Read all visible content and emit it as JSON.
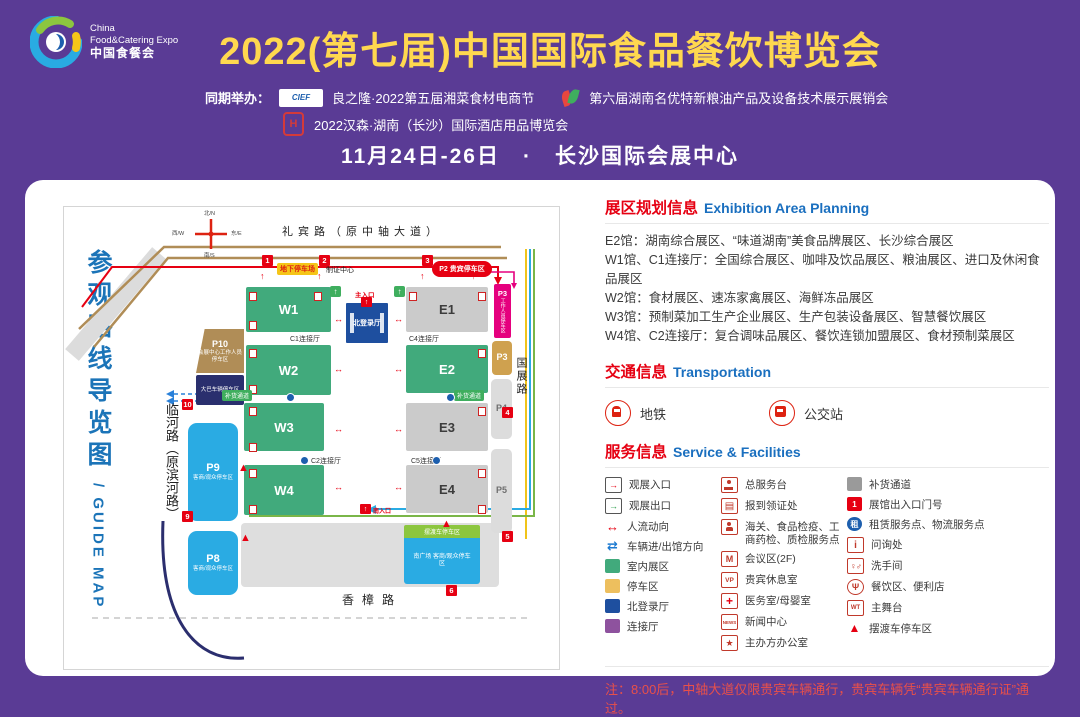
{
  "theme": {
    "purple": "#5a3b95",
    "title_yellow": "#ffd84f",
    "guide_blue": "#1b74b8",
    "section_red": "#e60012",
    "section_blue": "#1a6fbf",
    "hall_green": "#41aa7c",
    "hall_gray": "#cbcbcb",
    "north_hall_navy": "#1e4f9f",
    "parking_blue": "#2aabe3",
    "vip_red": "#e60012",
    "staff_magenta": "#e5007e",
    "tan": "#b08d57"
  },
  "header": {
    "logo": {
      "line1": "China",
      "line2": "Food&Catering Expo",
      "line3": "中国食餐会"
    },
    "title": "2022(第七届)中国国际食品餐饮博览会",
    "co_label": "同期举办：",
    "cief_logo_text": "CIEF",
    "hansen_logo_text": "H",
    "co_event1": "良之隆·2022第五届湘菜食材电商节",
    "co_event2": "第六届湖南名优特新粮油产品及设备技术展示展销会",
    "co_event3": "2022汉森·湖南（长沙）国际酒店用品博览会",
    "date_venue": "11月24日-26日　·　长沙国际会展中心"
  },
  "guide_title": {
    "cn": "参观路线导览图",
    "en": "/ GUIDE MAP"
  },
  "map": {
    "compass": {
      "n": "北/N",
      "w": "西/W",
      "e": "东/E",
      "s": "南/S"
    },
    "roads": {
      "top": "礼宾路（原中轴大道）",
      "left": "临河路（原滨河路）",
      "right": "国展路",
      "bottom": "香樟路"
    },
    "halls": {
      "w1": "W1",
      "w2": "W2",
      "w3": "W3",
      "w4": "W4",
      "e1": "E1",
      "e2": "E2",
      "e3": "E3",
      "e4": "E4",
      "north": "北登录厅"
    },
    "connectors": {
      "c1": "C1连接厅",
      "c2": "C2连接厅",
      "c4": "C4连接厅",
      "c5": "C5连接厅"
    },
    "labels": {
      "underground": "地下停车场",
      "cert": "制证中心",
      "main_entrance": "主入口",
      "south_entrance": "南入口",
      "restock": "补货通道",
      "shuttle_bar": "摆渡车停车区"
    },
    "parking": {
      "p10_id": "P10",
      "p10": "会展中心工作人员停车区",
      "bus": "大巴车辆停车区",
      "p9_id": "P9",
      "p8_id": "P8",
      "visitor": "客商/观众停车区",
      "p2": "P2 贵宾停车区",
      "p3a_id": "P3",
      "p3a": "工作人员停车区",
      "p3b": "P3",
      "p4": "P4",
      "p5": "P5",
      "south_plaza": "南广场 客商/观众停车区"
    },
    "gates": {
      "g1": "1",
      "g2": "2",
      "g3": "3",
      "g4": "4",
      "g5": "5",
      "g6": "6",
      "g9": "9",
      "g10": "10"
    },
    "icons": {
      "up": "↑",
      "left": "←",
      "both": "↔",
      "tri": "▲"
    }
  },
  "panel": {
    "exhibition": {
      "title_cn": "展区规划信息",
      "title_en": "Exhibition Area Planning",
      "lines": [
        "E2馆：湖南综合展区、“味道湖南”美食品牌展区、长沙综合展区",
        "W1馆、C1连接厅：全国综合展区、咖啡及饮品展区、粮油展区、进口及休闲食品展区",
        "W2馆：食材展区、速冻家禽展区、海鲜冻品展区",
        "W3馆：预制菜加工生产企业展区、生产包装设备展区、智慧餐饮展区",
        "W4馆、C2连接厅：复合调味品展区、餐饮连锁加盟展区、食材预制菜展区"
      ]
    },
    "transport": {
      "title_cn": "交通信息",
      "title_en": "Transportation",
      "items": [
        "地铁",
        "公交站"
      ]
    },
    "services": {
      "title_cn": "服务信息",
      "title_en": "Service & Facilities",
      "items": [
        {
          "icon": "entrance-in-icon",
          "label": "观展入口",
          "glyph": "→"
        },
        {
          "icon": "exit-out-icon",
          "label": "观展出口",
          "glyph": "→"
        },
        {
          "icon": "people-flow-icon",
          "label": "人流动向",
          "glyph": "↔"
        },
        {
          "icon": "vehicle-direction-icon",
          "label": "车辆进/出馆方向",
          "glyph": "⇄"
        },
        {
          "icon": "indoor-hall-swatch",
          "label": "室内展区"
        },
        {
          "icon": "parking-swatch",
          "label": "停车区"
        },
        {
          "icon": "north-hall-swatch",
          "label": "北登录厅"
        },
        {
          "icon": "connector-swatch",
          "label": "连接厅"
        },
        {
          "icon": "service-desk-icon",
          "label": "总服务台"
        },
        {
          "icon": "registration-icon",
          "label": "报到领证处",
          "glyph": "▤"
        },
        {
          "icon": "customs-icon",
          "label": "海关、食品检疫、工商药检、质检服务点"
        },
        {
          "icon": "meeting-icon",
          "label": "会议区(2F)",
          "glyph": "M"
        },
        {
          "icon": "vip-lounge-icon",
          "label": "贵宾休息室",
          "glyph": "VP"
        },
        {
          "icon": "medical-icon",
          "label": "医务室/母婴室",
          "glyph": "+"
        },
        {
          "icon": "news-center-icon",
          "label": "新闻中心",
          "glyph": "NEWS"
        },
        {
          "icon": "organizer-office-icon",
          "label": "主办方办公室",
          "glyph": "★"
        },
        {
          "icon": "restock-swatch",
          "label": "补货通道"
        },
        {
          "icon": "gate-number-icon",
          "label": "展馆出入口门号",
          "glyph": "1"
        },
        {
          "icon": "rental-logistics-icon",
          "label": "租赁服务点、物流服务点",
          "glyph": "租"
        },
        {
          "icon": "info-icon",
          "label": "问询处",
          "glyph": "i"
        },
        {
          "icon": "restroom-icon",
          "label": "洗手间",
          "glyph": "♀♂"
        },
        {
          "icon": "dining-icon",
          "label": "餐饮区、便利店",
          "glyph": "Ψ"
        },
        {
          "icon": "main-stage-icon",
          "label": "主舞台",
          "glyph": "WT"
        },
        {
          "icon": "shuttle-parking-icon",
          "label": "摆渡车停车区",
          "glyph": "▲"
        }
      ]
    },
    "note": "注：8:00后，中轴大道仅限贵宾车辆通行，贵宾车辆凭“贵宾车辆通行证”通过。"
  }
}
